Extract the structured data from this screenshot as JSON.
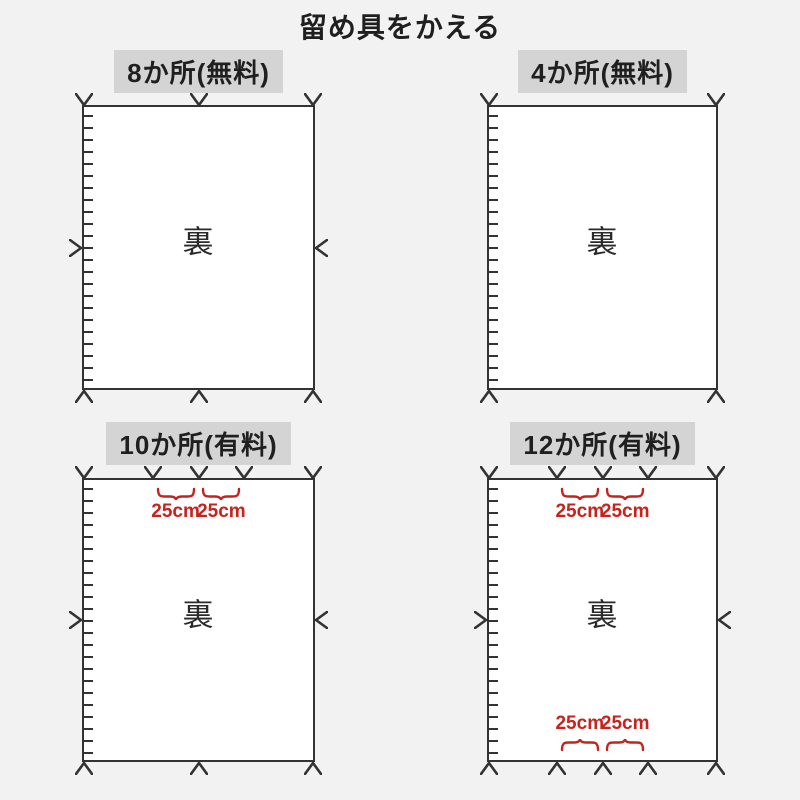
{
  "title": "留め具をかえる",
  "annotation_label": "25cm",
  "colors": {
    "background": "#f2f2f2",
    "label_background": "#d4d4d4",
    "line": "#333333",
    "rect_fill": "#ffffff",
    "accent_red": "#c8221c",
    "text": "#1f1f1f"
  },
  "panels": [
    {
      "label": "8か所(無料)",
      "center_text": "裏",
      "top_positions": [
        0,
        50,
        100
      ],
      "bottom_positions": [
        0,
        50,
        100
      ],
      "side_markers": true,
      "annotation_top": false,
      "annotation_bottom": false
    },
    {
      "label": "4か所(無料)",
      "center_text": "裏",
      "top_positions": [
        0,
        100
      ],
      "bottom_positions": [
        0,
        100
      ],
      "side_markers": false,
      "annotation_top": false,
      "annotation_bottom": false
    },
    {
      "label": "10か所(有料)",
      "center_text": "裏",
      "top_positions": [
        0,
        30,
        50,
        70,
        100
      ],
      "bottom_positions": [
        0,
        50,
        100
      ],
      "side_markers": true,
      "annotation_top": true,
      "annotation_bottom": false
    },
    {
      "label": "12か所(有料)",
      "center_text": "裏",
      "top_positions": [
        0,
        30,
        50,
        70,
        100
      ],
      "bottom_positions": [
        0,
        30,
        50,
        70,
        100
      ],
      "side_markers": true,
      "annotation_top": true,
      "annotation_bottom": true
    }
  ]
}
